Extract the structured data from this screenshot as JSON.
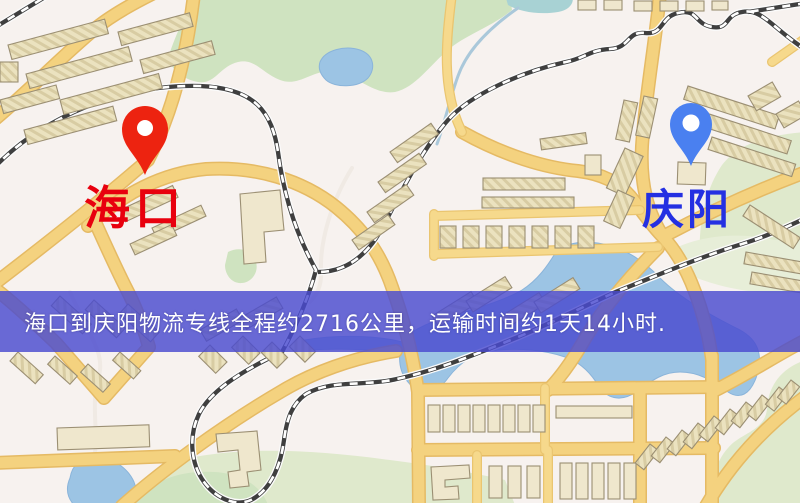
{
  "map": {
    "type": "road-map",
    "colors": {
      "background": "#f7f2ef",
      "road_major": "#f4d27f",
      "road_casing": "#e5ba64",
      "water": "#9cc4e4",
      "park_green": "#cfe3c0",
      "building_fill": "#ebe2bf",
      "railway_dark": "#3f3f3f"
    }
  },
  "markers": {
    "origin": {
      "name": "海口",
      "pin_color": "#ed2310",
      "pin_hole_color": "#ffffff",
      "label_color": "#e8000e"
    },
    "destination": {
      "name": "庆阳",
      "pin_color": "#4a80f0",
      "pin_hole_color": "#ffffff",
      "label_color": "#2430e2"
    }
  },
  "banner": {
    "text": "海口到庆阳物流专线全程约2716公里，运输时间约1天14小时.",
    "background": "#494bd0",
    "text_color": "#ffffff",
    "route": {
      "origin": "海口",
      "destination": "庆阳",
      "distance": "约2716公里",
      "duration": "约1天14小时"
    }
  }
}
